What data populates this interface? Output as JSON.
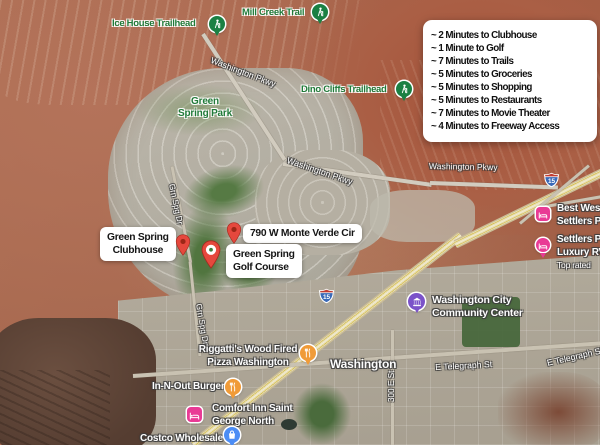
{
  "info_box": {
    "items": [
      "~ 2 Minutes to Clubhouse",
      "~ 1 Minute to Golf",
      "~ 7 Minutes to Trails",
      "~ 5 Minutes to Groceries",
      "~ 5 Minutes to Shopping",
      "~ 5 Minutes to Restaurants",
      "~ 7 Minutes to Movie Theater",
      "~ 4 Minutes to Freeway Access"
    ]
  },
  "custom_markers": {
    "clubhouse": {
      "line1": "Green Spring",
      "line2": "Clubhouse"
    },
    "address": {
      "label": "790 W Monte Verde Cir"
    },
    "golf_course": {
      "line1": "Green Spring",
      "line2": "Golf Course"
    }
  },
  "trail_labels": {
    "ice_house": "Ice House Trailhead",
    "mill_creek": "Mill Creek Trail",
    "dino_cliffs": "Dino Cliffs Trailhead"
  },
  "park_labels": {
    "green_spring_park": {
      "line1": "Green",
      "line2": "Spring Park"
    }
  },
  "road_labels": {
    "washington_pkwy": "Washington Pkwy",
    "grn_spg_dr": "Grn Spg Dr",
    "e_telegraph_st": "E Telegraph St",
    "street_300_e": "300 E St",
    "interstate_15": "15"
  },
  "place_labels": {
    "riggattis": {
      "line1": "Riggatti's Wood Fired",
      "line2": "Pizza Washington"
    },
    "in_n_out": "In-N-Out Burger",
    "comfort_inn": {
      "line1": "Comfort Inn Saint",
      "line2": "George North"
    },
    "costco": "Costco Wholesale",
    "washington_city": "Washington",
    "community_center": {
      "line1": "Washington City",
      "line2": "Community Center"
    },
    "best_western": {
      "line1": "Best West",
      "line2": "Settlers P"
    },
    "settlers_rv": {
      "line1": "Settlers P",
      "line2": "Luxury RV",
      "line3": "Top rated"
    }
  },
  "colors": {
    "marker_red": "#E5483D",
    "trail_green": "#1B8043",
    "park_text_green": "#1F7A38",
    "restaurant_orange": "#F09B38",
    "lodging_pink": "#E93A95",
    "shopping_blue": "#4C8DF5",
    "civic_purple": "#7B52C9",
    "shield_blue": "#3A6AB8",
    "shield_red": "#C03B31",
    "label_bg": "#FFFFFF",
    "label_text": "#111111"
  }
}
